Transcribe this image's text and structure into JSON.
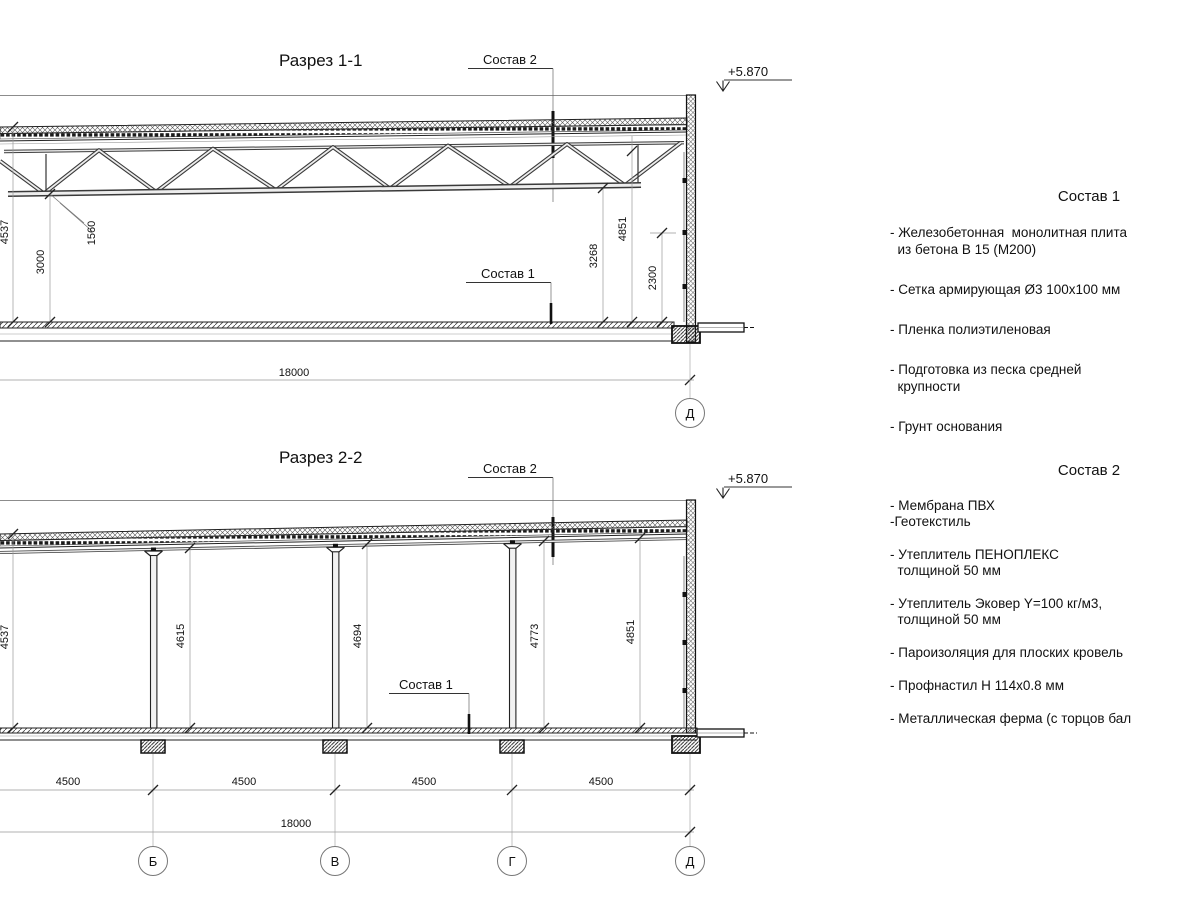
{
  "s1": {
    "title": "Разрез 1-1",
    "sostav2_label": "Состав 2",
    "sostav1_label": "Состав 1",
    "elevation": "+5.870",
    "dim_left_height": "4537",
    "dim_truss_height": "1560",
    "dim_clear_height": "3000",
    "dim_right_truss": "3268",
    "dim_right_height": "4851",
    "dim_right_wall": "2300",
    "dim_span": "18000",
    "grid_letter": "Д"
  },
  "s2": {
    "title": "Разрез 2-2",
    "sostav2_label": "Состав 2",
    "sostav1_label": "Состав 1",
    "elevation": "+5.870",
    "heights": [
      "4537",
      "4615",
      "4694",
      "4773",
      "4851"
    ],
    "bays": [
      "4500",
      "4500",
      "4500",
      "4500"
    ],
    "dim_span": "18000",
    "grid_letters": [
      "Б",
      "В",
      "Г",
      "Д"
    ]
  },
  "materials": {
    "sostav1": {
      "title": "Состав 1",
      "items": [
        "- Железобетонная  монолитная плита\n  из бетона В 15 (М200)",
        "- Сетка армирующая Ø3 100х100 мм",
        "- Пленка полиэтиленовая",
        "- Подготовка из песка средней\n  крупности",
        "- Грунт основания"
      ]
    },
    "sostav2": {
      "title": "Состав 2",
      "items": [
        "- Мембрана ПВХ\n-Геотекстиль",
        "- Утеплитель ПЕНОПЛЕКС\n  толщиной 50 мм",
        "- Утеплитель Эковер Y=100 кг/м3,\n  толщиной 50 мм",
        "- Пароизоляция для плоских кровель",
        "- Профнастил Н 114х0.8 мм",
        "- Металлическая ферма (с торцов бал"
      ]
    }
  }
}
